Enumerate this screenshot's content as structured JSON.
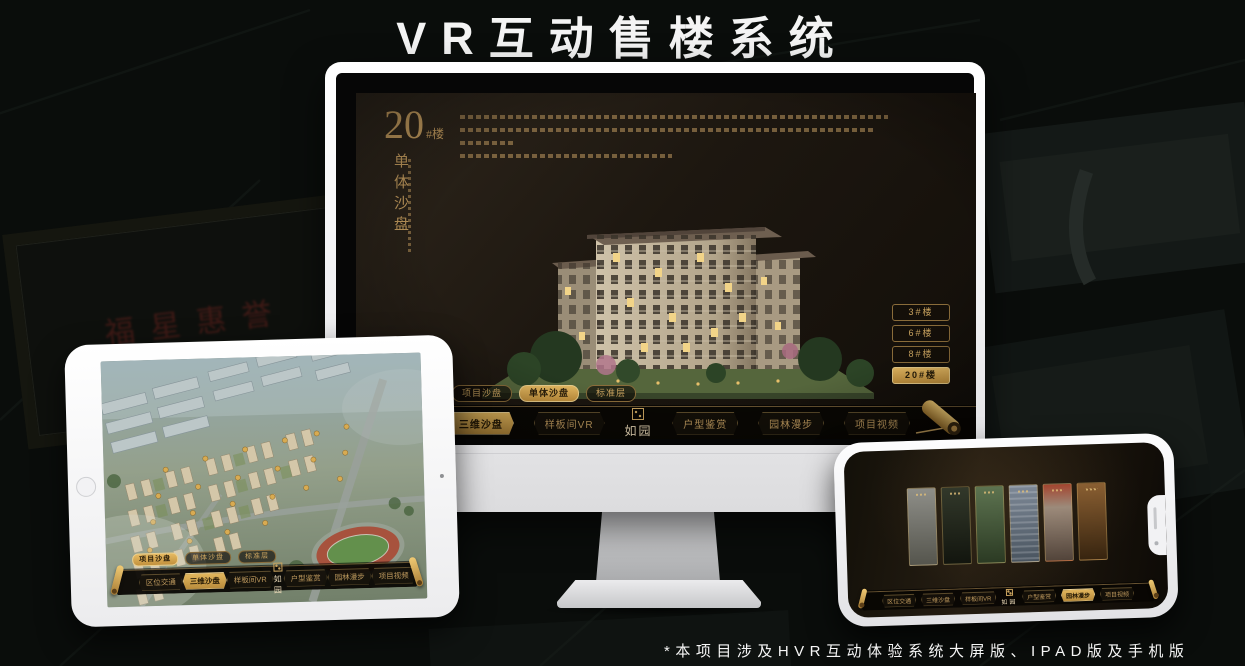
{
  "page": {
    "title": "VR互动售楼系统",
    "footnote": "*本项目涉及HVR互动体验系统大屏版、IPAD版及手机版"
  },
  "colors": {
    "gold_accent": "#c59c5c",
    "gold_active": "#d9a84e",
    "screen_background": "#1d1710",
    "device_frame": "#f2f2f4"
  },
  "background": {
    "plaque_text": "福星惠誉"
  },
  "desktop": {
    "unit_number": "20",
    "unit_suffix": "#楼",
    "unit_subtitle": "单体沙盘",
    "floor_buttons": [
      {
        "label": "3#楼",
        "active": false
      },
      {
        "label": "6#楼",
        "active": false
      },
      {
        "label": "8#楼",
        "active": false
      },
      {
        "label": "20#楼",
        "active": true
      }
    ],
    "view_tabs": [
      {
        "label": "项目沙盘",
        "active": false
      },
      {
        "label": "单体沙盘",
        "active": true
      },
      {
        "label": "标准层",
        "active": false
      }
    ],
    "nav_items": [
      {
        "label": "区位交通",
        "active": false
      },
      {
        "label": "三维沙盘",
        "active": true
      },
      {
        "label": "样板间VR",
        "active": false
      },
      {
        "label": "户型鉴赏",
        "active": false
      },
      {
        "label": "园林漫步",
        "active": false
      },
      {
        "label": "项目视频",
        "active": false
      }
    ],
    "logo": "如园"
  },
  "tablet": {
    "view_tabs": [
      {
        "label": "项目沙盘",
        "active": true
      },
      {
        "label": "单体沙盘",
        "active": false
      },
      {
        "label": "标准层",
        "active": false
      }
    ],
    "nav_items": [
      {
        "label": "区位交通",
        "active": false
      },
      {
        "label": "三维沙盘",
        "active": true
      },
      {
        "label": "样板间VR",
        "active": false
      },
      {
        "label": "户型鉴赏",
        "active": false
      },
      {
        "label": "园林漫步",
        "active": false
      },
      {
        "label": "项目视频",
        "active": false
      }
    ],
    "logo": "如园"
  },
  "phone": {
    "nav_items": [
      {
        "label": "区位交通",
        "active": false
      },
      {
        "label": "三维沙盘",
        "active": false
      },
      {
        "label": "样板间VR",
        "active": false
      },
      {
        "label": "户型鉴赏",
        "active": false
      },
      {
        "label": "园林漫步",
        "active": true
      },
      {
        "label": "项目视频",
        "active": false
      }
    ],
    "logo": "如园"
  }
}
